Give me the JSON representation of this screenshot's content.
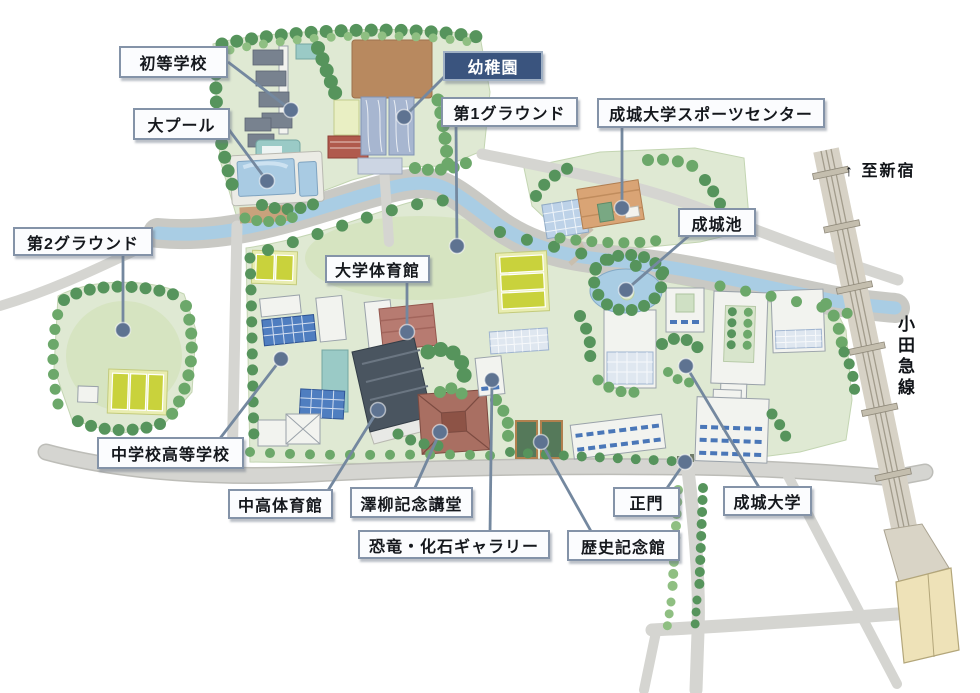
{
  "map_labels": [
    {
      "id": "elementary-school",
      "text": "初等学校",
      "variant": "light",
      "box": {
        "x": 119,
        "y": 46,
        "w": 109,
        "h": 32
      },
      "line": {
        "x1": 228,
        "y1": 62
      },
      "dot": {
        "x": 291,
        "y": 110
      }
    },
    {
      "id": "kindergarten",
      "text": "幼稚園",
      "variant": "dark",
      "box": {
        "x": 443,
        "y": 51,
        "w": 100,
        "h": 30
      },
      "line": {
        "x1": 449,
        "y1": 72
      },
      "dot": {
        "x": 404,
        "y": 117
      }
    },
    {
      "id": "main-pool",
      "text": "大プール",
      "variant": "light",
      "box": {
        "x": 133,
        "y": 108,
        "w": 97,
        "h": 32
      },
      "line": {
        "x1": 227,
        "y1": 127
      },
      "dot": {
        "x": 267,
        "y": 181
      }
    },
    {
      "id": "ground-1",
      "text": "第1グラウンド",
      "variant": "light",
      "box": {
        "x": 441,
        "y": 97,
        "w": 137,
        "h": 30
      },
      "line": {
        "x1": 456,
        "y1": 124
      },
      "dot": {
        "x": 457,
        "y": 246
      }
    },
    {
      "id": "sports-center",
      "text": "成城大学スポーツセンター",
      "variant": "light",
      "box": {
        "x": 597,
        "y": 98,
        "w": 228,
        "h": 30
      },
      "line": {
        "x1": 622,
        "y1": 125
      },
      "dot": {
        "x": 622,
        "y": 208
      }
    },
    {
      "id": "seijo-pond",
      "text": "成城池",
      "variant": "light",
      "box": {
        "x": 678,
        "y": 208,
        "w": 78,
        "h": 29
      },
      "line": {
        "x1": 691,
        "y1": 234
      },
      "dot": {
        "x": 626,
        "y": 290
      }
    },
    {
      "id": "ground-2",
      "text": "第2グラウンド",
      "variant": "light",
      "box": {
        "x": 13,
        "y": 227,
        "w": 140,
        "h": 29
      },
      "line": {
        "x1": 123,
        "y1": 253
      },
      "dot": {
        "x": 123,
        "y": 330
      }
    },
    {
      "id": "univ-gym",
      "text": "大学体育館",
      "variant": "light",
      "box": {
        "x": 325,
        "y": 255,
        "w": 105,
        "h": 28
      },
      "line": {
        "x1": 407,
        "y1": 280
      },
      "dot": {
        "x": 407,
        "y": 332
      }
    },
    {
      "id": "junior-senior-high",
      "text": "中学校高等学校",
      "variant": "light",
      "box": {
        "x": 97,
        "y": 437,
        "w": 147,
        "h": 32
      },
      "line": {
        "x1": 218,
        "y1": 441
      },
      "dot": {
        "x": 281,
        "y": 359
      }
    },
    {
      "id": "jshs-gym",
      "text": "中高体育館",
      "variant": "light",
      "box": {
        "x": 228,
        "y": 489,
        "w": 105,
        "h": 30
      },
      "line": {
        "x1": 327,
        "y1": 492
      },
      "dot": {
        "x": 378,
        "y": 410
      }
    },
    {
      "id": "sawayanagi-hall",
      "text": "澤柳記念講堂",
      "variant": "light",
      "box": {
        "x": 350,
        "y": 487,
        "w": 123,
        "h": 31
      },
      "line": {
        "x1": 414,
        "y1": 490
      },
      "dot": {
        "x": 440,
        "y": 432
      }
    },
    {
      "id": "dino-fossil-gallery",
      "text": "恐竜・化石ギャラリー",
      "variant": "light",
      "box": {
        "x": 358,
        "y": 530,
        "w": 192,
        "h": 29
      },
      "line": {
        "x1": 490,
        "y1": 533
      },
      "dot": {
        "x": 492,
        "y": 380
      }
    },
    {
      "id": "history-hall",
      "text": "歴史記念館",
      "variant": "light",
      "box": {
        "x": 567,
        "y": 530,
        "w": 113,
        "h": 31
      },
      "line": {
        "x1": 592,
        "y1": 533
      },
      "dot": {
        "x": 541,
        "y": 442
      }
    },
    {
      "id": "main-gate",
      "text": "正門",
      "variant": "light",
      "box": {
        "x": 613,
        "y": 487,
        "w": 67,
        "h": 30
      },
      "line": {
        "x1": 665,
        "y1": 491
      },
      "dot": {
        "x": 685,
        "y": 462
      }
    },
    {
      "id": "seijo-university",
      "text": "成城大学",
      "variant": "light",
      "box": {
        "x": 723,
        "y": 486,
        "w": 89,
        "h": 30
      },
      "line": {
        "x1": 760,
        "y1": 489
      },
      "dot": {
        "x": 686,
        "y": 366
      }
    }
  ],
  "annotations": [
    {
      "id": "to-shinjuku",
      "text": "↑ 至新宿",
      "x": 845,
      "y": 157,
      "vertical": false
    },
    {
      "id": "odakyu-line",
      "text": "小田急線",
      "x": 892,
      "y": 315,
      "vertical": true
    }
  ],
  "palette": {
    "label-bg": "#fbfcfe",
    "label-border": "#8493a8",
    "label-dark-bg": "#3a547e",
    "leader": "#74889f",
    "marker": "#5e7391",
    "campus-green": "#dfe9d3",
    "field-green": "#d6e4c1",
    "river-blue": "#a9cde4",
    "road-gray": "#d5d5d1",
    "railway-tan": "#d7d2c6",
    "tennis-yellow": "#c9d23c",
    "dirt-brown": "#b8895f",
    "station-cream": "#eee2b8"
  }
}
